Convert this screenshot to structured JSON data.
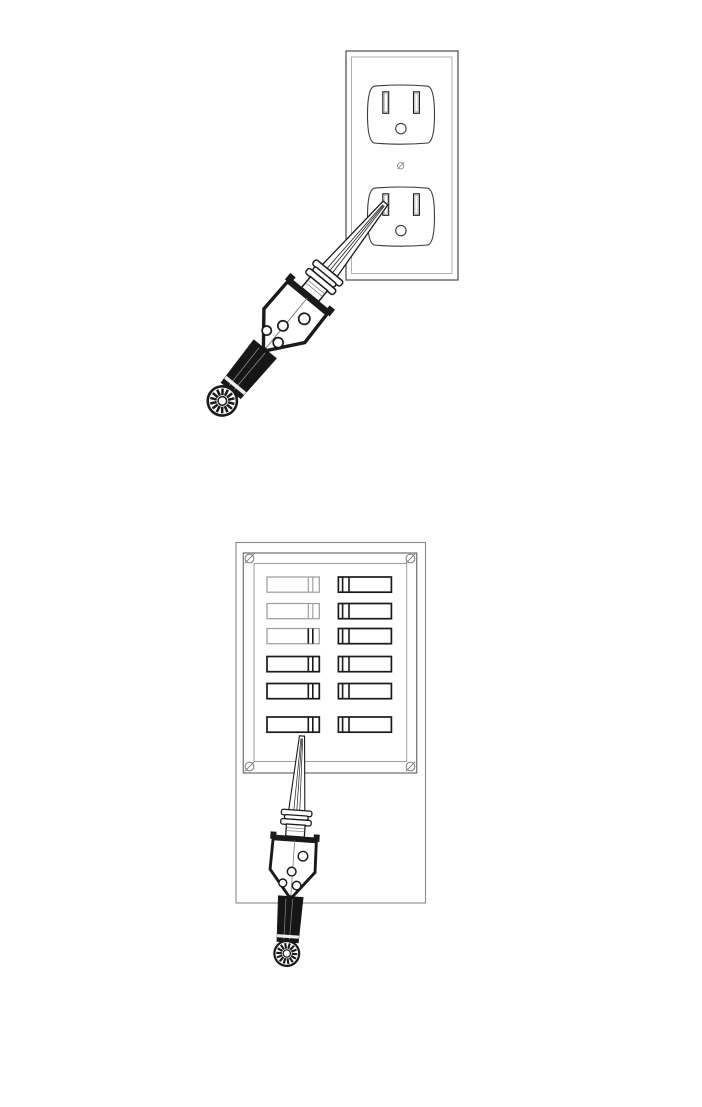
{
  "page": {
    "background": "#ffffff",
    "width": 702,
    "height": 1107
  },
  "colors": {
    "line_dark": "#1a1a1a",
    "line_mid": "#4a4a4a",
    "line_soft": "#777777",
    "line_light": "#9e9e9e",
    "line_faint": "#b2b2b2",
    "handle_fill": "#161616",
    "paper": "#ffffff"
  },
  "figures": [
    {
      "id": "outlet-test",
      "subject": "duplex-wall-outlet",
      "receptacle_count": 2,
      "slots_per_receptacle": 2,
      "ground_holes_per_receptacle": 1,
      "center_screws": 1,
      "probe_state": "inserted-in-lower-left-slot",
      "probe_angle_deg": 39.5
    },
    {
      "id": "breaker-panel-test",
      "subject": "circuit-breaker-panel",
      "breaker_rows": 6,
      "breaker_columns": 2,
      "breaker_count": 12,
      "corner_screws": 4,
      "probe_state": "tip-touching-bottom-left-breaker",
      "probe_angle_deg": 4
    }
  ],
  "panel": {
    "left_breakers": [
      {
        "body": "light",
        "toggle": "light"
      },
      {
        "body": "light",
        "toggle": "light"
      },
      {
        "body": "light",
        "toggle": "dark"
      },
      {
        "body": "dark",
        "toggle": "dark"
      },
      {
        "body": "dark",
        "toggle": "dark"
      },
      {
        "body": "dark",
        "toggle": "dark"
      }
    ],
    "right_breakers": [
      {
        "body": "dark",
        "toggle": "dark"
      },
      {
        "body": "dark",
        "toggle": "dark"
      },
      {
        "body": "dark",
        "toggle": "dark"
      },
      {
        "body": "dark",
        "toggle": "dark"
      },
      {
        "body": "dark",
        "toggle": "dark"
      },
      {
        "body": "dark",
        "toggle": "dark"
      }
    ]
  },
  "probe": {
    "parts": [
      "tip-cone",
      "ribbed-collar",
      "neck",
      "shield-body",
      "indicator-holes",
      "grip-handle",
      "end-cap"
    ],
    "indicator_holes": 4,
    "collar_ribs": 3,
    "cone_inner_lines": 3,
    "handle_stripes": 2,
    "cap_spokes": 14
  }
}
